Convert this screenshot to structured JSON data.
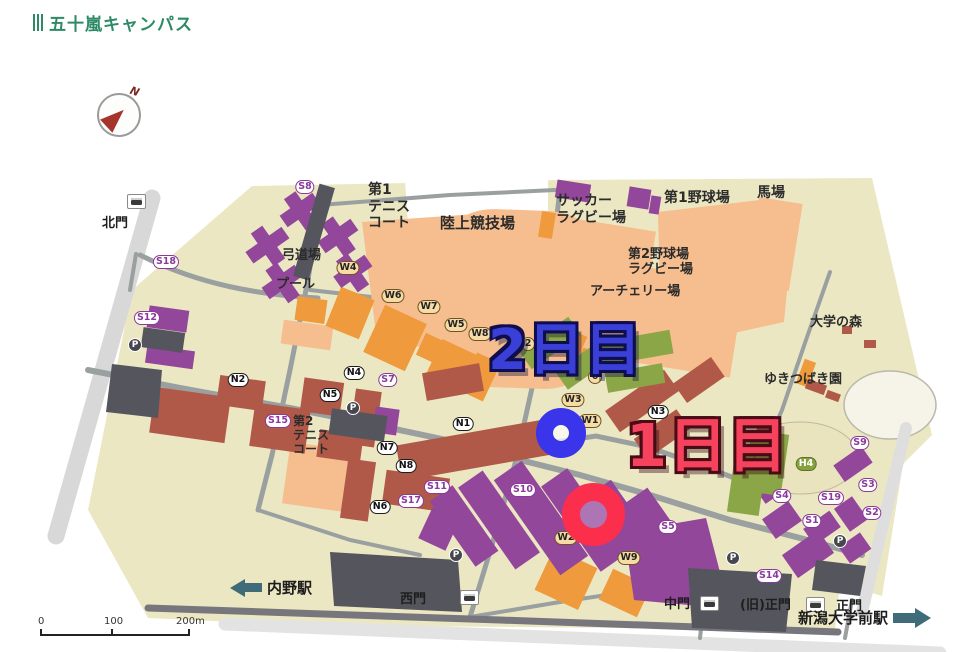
{
  "header": {
    "title": "五十嵐キャンパス",
    "accent_color": "#2e8a66"
  },
  "compass": {
    "label": "N"
  },
  "annotations": {
    "day2": {
      "label": "2日目",
      "color": "#3a3fd8"
    },
    "day1": {
      "label": "1日目",
      "color": "#f6425c"
    }
  },
  "map": {
    "scale_labels": [
      "0",
      "100",
      "200m"
    ],
    "stations": {
      "left": {
        "label": "内野駅"
      },
      "right": {
        "label": "新潟大学前駅"
      }
    },
    "gates": [
      {
        "label": "北門",
        "x": 102,
        "y": 172,
        "fs": 13,
        "bus": {
          "x": 127,
          "y": 154
        }
      },
      {
        "label": "西門",
        "x": 400,
        "y": 548,
        "fs": 13,
        "bus": {
          "x": 460,
          "y": 550
        }
      },
      {
        "label": "中門",
        "x": 664,
        "y": 553,
        "fs": 13,
        "bus": {
          "x": 700,
          "y": 556
        }
      },
      {
        "label": "(旧)正門",
        "x": 740,
        "y": 554,
        "fs": 13,
        "bus": {
          "x": 806,
          "y": 557
        }
      },
      {
        "label": "正門",
        "x": 836,
        "y": 555,
        "fs": 13
      }
    ],
    "area_labels": [
      {
        "name": "area-tennis-court-1",
        "lines": [
          "第1",
          "テニス",
          "コート"
        ],
        "x": 368,
        "y": 142,
        "fs": 14
      },
      {
        "name": "area-athletics-field",
        "lines": [
          "陸上競技場"
        ],
        "x": 440,
        "y": 175,
        "fs": 15
      },
      {
        "name": "area-soccer-rugby-field",
        "lines": [
          "サッカー",
          "ラグビー場"
        ],
        "x": 556,
        "y": 153,
        "fs": 14
      },
      {
        "name": "area-baseball-field-1",
        "lines": [
          "第1野球場"
        ],
        "x": 664,
        "y": 150,
        "fs": 14
      },
      {
        "name": "area-horse-riding-ground",
        "lines": [
          "馬場"
        ],
        "x": 757,
        "y": 145,
        "fs": 14
      },
      {
        "name": "area-baseball-rugby-field-2",
        "lines": [
          "第2野球場",
          "ラグビー場"
        ],
        "x": 628,
        "y": 207,
        "fs": 13
      },
      {
        "name": "area-archery-field",
        "lines": [
          "アーチェリー場"
        ],
        "x": 590,
        "y": 244,
        "fs": 13
      },
      {
        "name": "area-university-forest",
        "lines": [
          "大学の森"
        ],
        "x": 810,
        "y": 275,
        "fs": 13
      },
      {
        "name": "area-yukitsubaki-garden",
        "lines": [
          "ゆきつばき園"
        ],
        "x": 764,
        "y": 332,
        "fs": 13
      },
      {
        "name": "area-kyudo-hall",
        "lines": [
          "弓道場"
        ],
        "x": 282,
        "y": 208,
        "fs": 13
      },
      {
        "name": "area-pool",
        "lines": [
          "プール"
        ],
        "x": 276,
        "y": 237,
        "fs": 13
      },
      {
        "name": "area-tennis-court-2",
        "lines": [
          "第2",
          "テニス",
          "コート"
        ],
        "x": 293,
        "y": 374,
        "fs": 12
      }
    ],
    "building_markers": [
      {
        "label": "S8",
        "series": "S",
        "x": 305,
        "y": 147
      },
      {
        "label": "S18",
        "series": "S",
        "x": 166,
        "y": 222
      },
      {
        "label": "S12",
        "series": "S",
        "x": 147,
        "y": 278
      },
      {
        "label": "N2",
        "series": "N",
        "x": 238,
        "y": 340
      },
      {
        "label": "W4",
        "series": "W",
        "x": 348,
        "y": 228
      },
      {
        "label": "W6",
        "series": "W",
        "x": 393,
        "y": 256
      },
      {
        "label": "W7",
        "series": "W",
        "x": 429,
        "y": 267
      },
      {
        "label": "W5",
        "series": "W",
        "x": 456,
        "y": 285
      },
      {
        "label": "W8",
        "series": "W",
        "x": 480,
        "y": 294
      },
      {
        "label": "N4",
        "series": "N",
        "x": 354,
        "y": 333
      },
      {
        "label": "S7",
        "series": "S",
        "x": 388,
        "y": 340
      },
      {
        "label": "N5",
        "series": "N",
        "x": 330,
        "y": 355
      },
      {
        "label": "S15",
        "series": "S",
        "x": 278,
        "y": 381
      },
      {
        "label": "N7",
        "series": "N",
        "x": 387,
        "y": 408
      },
      {
        "label": "N8",
        "series": "N",
        "x": 406,
        "y": 426
      },
      {
        "label": "S11",
        "series": "S",
        "x": 437,
        "y": 447
      },
      {
        "label": "S17",
        "series": "S",
        "x": 411,
        "y": 461
      },
      {
        "label": "N6",
        "series": "N",
        "x": 380,
        "y": 467
      },
      {
        "label": "N1",
        "series": "N",
        "x": 463,
        "y": 384
      },
      {
        "label": "2",
        "series": "W",
        "x": 528,
        "y": 304
      },
      {
        "label": "6",
        "series": "W",
        "x": 595,
        "y": 337
      },
      {
        "label": "W3",
        "series": "W",
        "x": 573,
        "y": 360
      },
      {
        "label": "W1",
        "series": "W",
        "x": 590,
        "y": 381
      },
      {
        "label": "N3",
        "series": "N",
        "x": 658,
        "y": 372
      },
      {
        "label": "S10",
        "series": "S",
        "x": 523,
        "y": 450
      },
      {
        "label": "W2",
        "series": "W",
        "x": 566,
        "y": 498
      },
      {
        "label": "W9",
        "series": "W",
        "x": 629,
        "y": 518
      },
      {
        "label": "S5",
        "series": "S",
        "x": 668,
        "y": 487
      },
      {
        "label": "S14",
        "series": "S",
        "x": 769,
        "y": 536
      },
      {
        "label": "S9",
        "series": "S",
        "x": 860,
        "y": 403
      },
      {
        "label": "H1",
        "series": "H",
        "x": 746,
        "y": 413
      },
      {
        "label": "H4",
        "series": "H",
        "x": 806,
        "y": 424
      },
      {
        "label": "S4",
        "series": "S",
        "x": 782,
        "y": 456
      },
      {
        "label": "S19",
        "series": "S",
        "x": 831,
        "y": 458
      },
      {
        "label": "S3",
        "series": "S",
        "x": 868,
        "y": 445
      },
      {
        "label": "S2",
        "series": "S",
        "x": 872,
        "y": 473
      },
      {
        "label": "S1",
        "series": "S",
        "x": 812,
        "y": 481
      }
    ],
    "parking_markers": [
      {
        "x": 135,
        "y": 305
      },
      {
        "x": 353,
        "y": 368
      },
      {
        "x": 456,
        "y": 515
      },
      {
        "x": 733,
        "y": 518
      },
      {
        "x": 840,
        "y": 501
      }
    ]
  }
}
